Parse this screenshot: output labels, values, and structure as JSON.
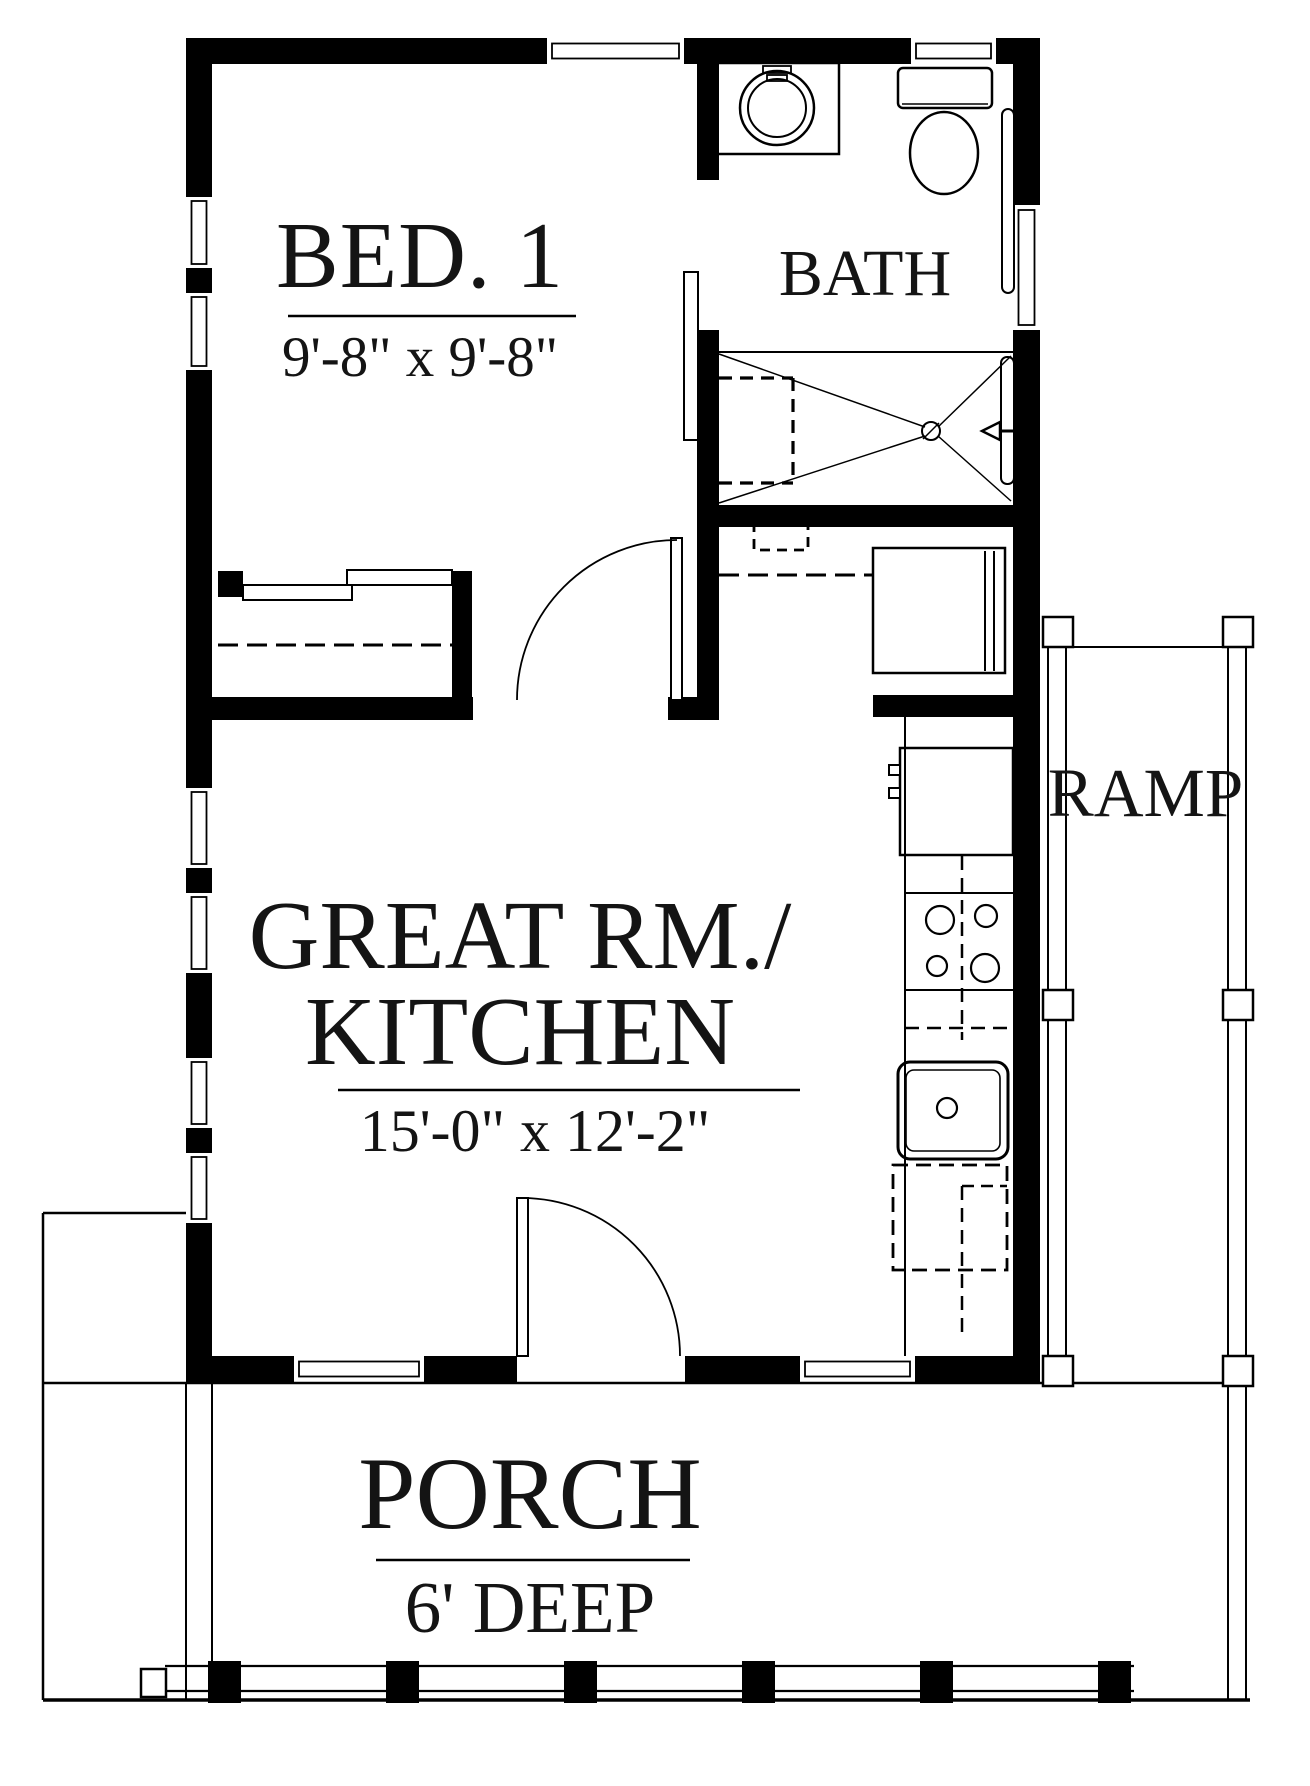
{
  "rooms": {
    "bedroom": {
      "label": "BED. 1",
      "dims": "9'-8\" x 9'-8\""
    },
    "bath": {
      "label": "BATH"
    },
    "great_room": {
      "label_line1": "GREAT RM./",
      "label_line2": "KITCHEN",
      "dims": "15'-0\" x 12'-2\""
    },
    "ramp": {
      "label": "RAMP"
    },
    "porch": {
      "label": "PORCH",
      "depth": "6' DEEP"
    }
  },
  "colors": {
    "wall": "#000000",
    "line": "#000000",
    "background": "#ffffff"
  },
  "fixtures": [
    "washer-icon",
    "toilet-icon",
    "shower-pan-icon",
    "shower-head-icon",
    "floor-drain-icon",
    "closet-sliding-doors-icon",
    "pocket-door-icon",
    "swing-door-icon",
    "refrigerator-icon",
    "range-cooktop-icon",
    "kitchen-sink-icon",
    "dishwasher-icon",
    "utility-appliance-icon",
    "ramp-post-icon",
    "porch-post-icon"
  ]
}
